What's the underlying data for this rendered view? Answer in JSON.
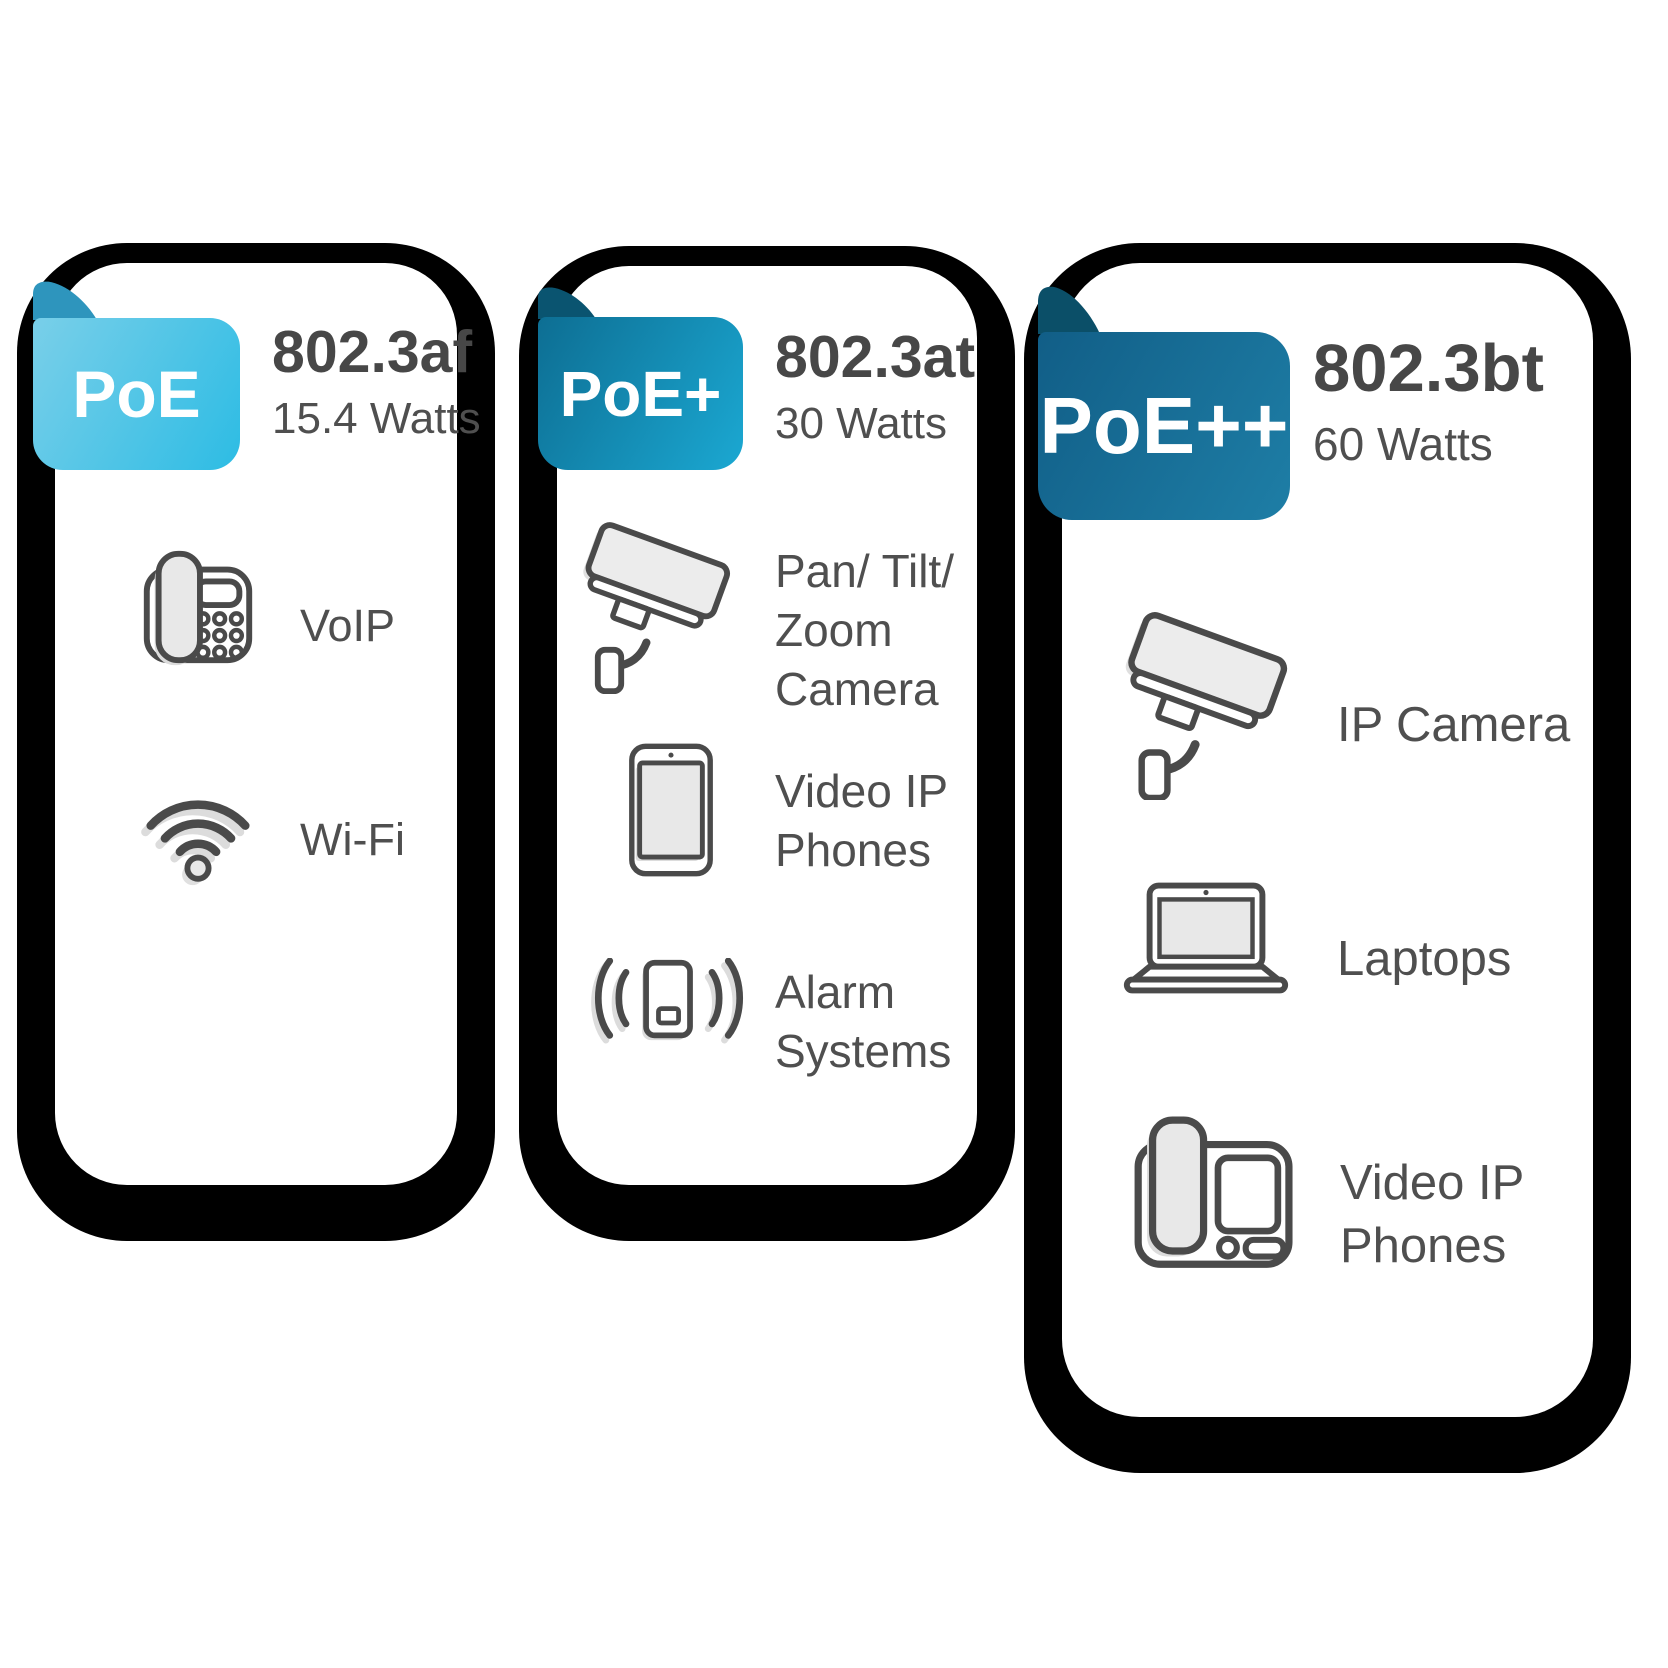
{
  "cards": [
    {
      "badge_label": "PoE",
      "standard": "802.3af",
      "watts": "15.4 Watts",
      "badge_gradient": [
        "#79cfe9",
        "#2dbce4"
      ],
      "fold_color": "#2e95bd",
      "items": [
        {
          "icon": "voip-phone-icon",
          "label": "VoIP"
        },
        {
          "icon": "wifi-icon",
          "label": "Wi-Fi"
        }
      ]
    },
    {
      "badge_label": "PoE+",
      "standard": "802.3at",
      "watts": "30 Watts",
      "badge_gradient": [
        "#0d6e93",
        "#1ba8d2"
      ],
      "fold_color": "#0a5470",
      "items": [
        {
          "icon": "ptz-camera-icon",
          "label": "Pan/ Tilt/\nZoom\nCamera"
        },
        {
          "icon": "tablet-video-ip-phone-icon",
          "label": "Video IP\nPhones"
        },
        {
          "icon": "alarm-system-icon",
          "label": "Alarm\nSystems"
        }
      ]
    },
    {
      "badge_label": "PoE++",
      "standard": "802.3bt",
      "watts": "60 Watts",
      "badge_gradient": [
        "#115e87",
        "#1e7ea6"
      ],
      "fold_color": "#0b4f68",
      "items": [
        {
          "icon": "ip-camera-icon",
          "label": "IP Camera"
        },
        {
          "icon": "laptop-icon",
          "label": "Laptops"
        },
        {
          "icon": "desk-video-ip-phone-icon",
          "label": "Video IP\nPhones"
        }
      ]
    }
  ],
  "colors": {
    "background": "#ffffff",
    "card_background": "#ffffff",
    "card_shadow": "#000000",
    "title_text": "#474747",
    "body_text": "#4f4f4f",
    "icon_stroke": "#4a4a4a",
    "icon_fill_light": "#e8e8e8",
    "icon_shadow": "#dcdcdc",
    "badge_text": "#ffffff"
  }
}
